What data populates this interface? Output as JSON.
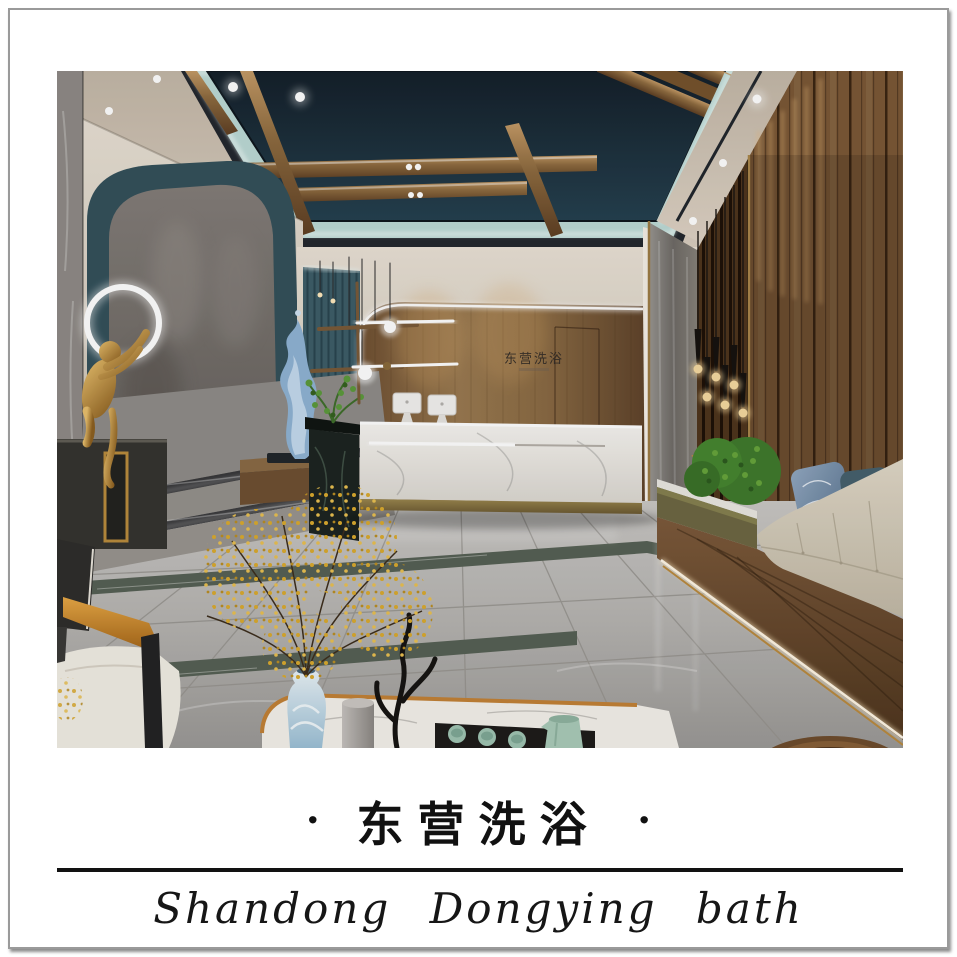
{
  "poster": {
    "dot_left": "·",
    "dot_right": "·",
    "title_cn": "东营洗浴",
    "subtitle_en": "Shandong Dongying bath"
  },
  "scene": {
    "wall_logo_text": "东营洗浴"
  },
  "palette": {
    "frame_border": "#9a9a9a",
    "divider_line": "#121212",
    "caption_text": "#111111",
    "ceiling_navy": "#1b2a35",
    "cove_mint": "#bfdcd8",
    "wood_wall": "#8a6a45",
    "teal_slat_wall": "#3f5f6a",
    "arch_band_teal": "#33505a",
    "marble_floor_gray": "#b7b5b2",
    "floor_inlay_green": "#566054",
    "desk_marble_white": "#f4f1ec",
    "gold_trim": "#c28136",
    "bench_cushion_cream": "#d6cdbb",
    "pillow_blue": "#7d93ad",
    "pillow_teal": "#46606d",
    "plant_green": "#4a7a2f",
    "flower_yellow": "#d9a92e",
    "sculpture_gold": "#b5802f",
    "sculpture_blue_wave": "#8fb3d4",
    "pendant_bulb_warm": "#f5d9a0"
  }
}
